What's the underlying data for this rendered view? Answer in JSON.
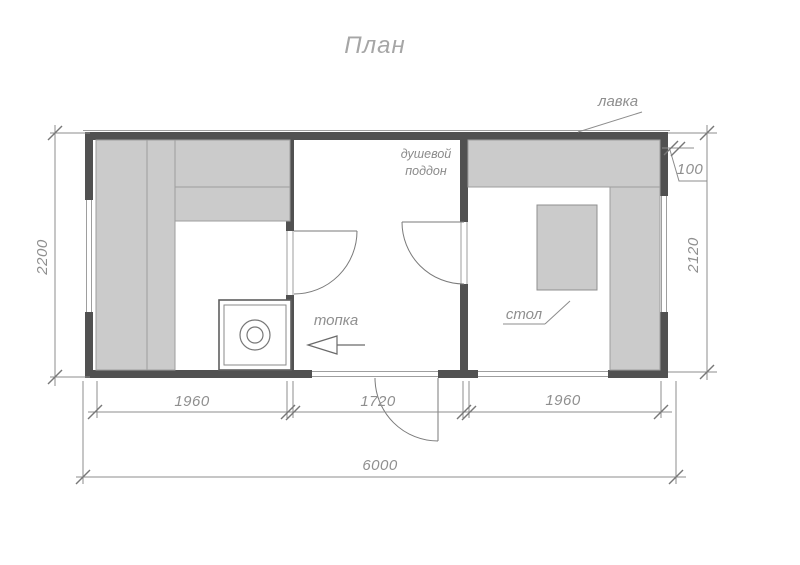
{
  "title": "План",
  "labels": {
    "bench": "лавка",
    "shower_tray": "душевой поддон",
    "firebox": "топка",
    "table": "стол"
  },
  "dims": {
    "height_left": "2200",
    "height_right": "2120",
    "offset_top_right": "100",
    "width_room_left": "1960",
    "width_room_middle": "1720",
    "width_room_right": "1960",
    "width_total": "6000"
  },
  "colors": {
    "wall": "#515151",
    "furniture_fill": "#cbcbcb",
    "furniture_border": "#9e9e9e",
    "drawing_line": "#8c8c8c",
    "text": "#8f8f8f",
    "background": "#ffffff"
  }
}
